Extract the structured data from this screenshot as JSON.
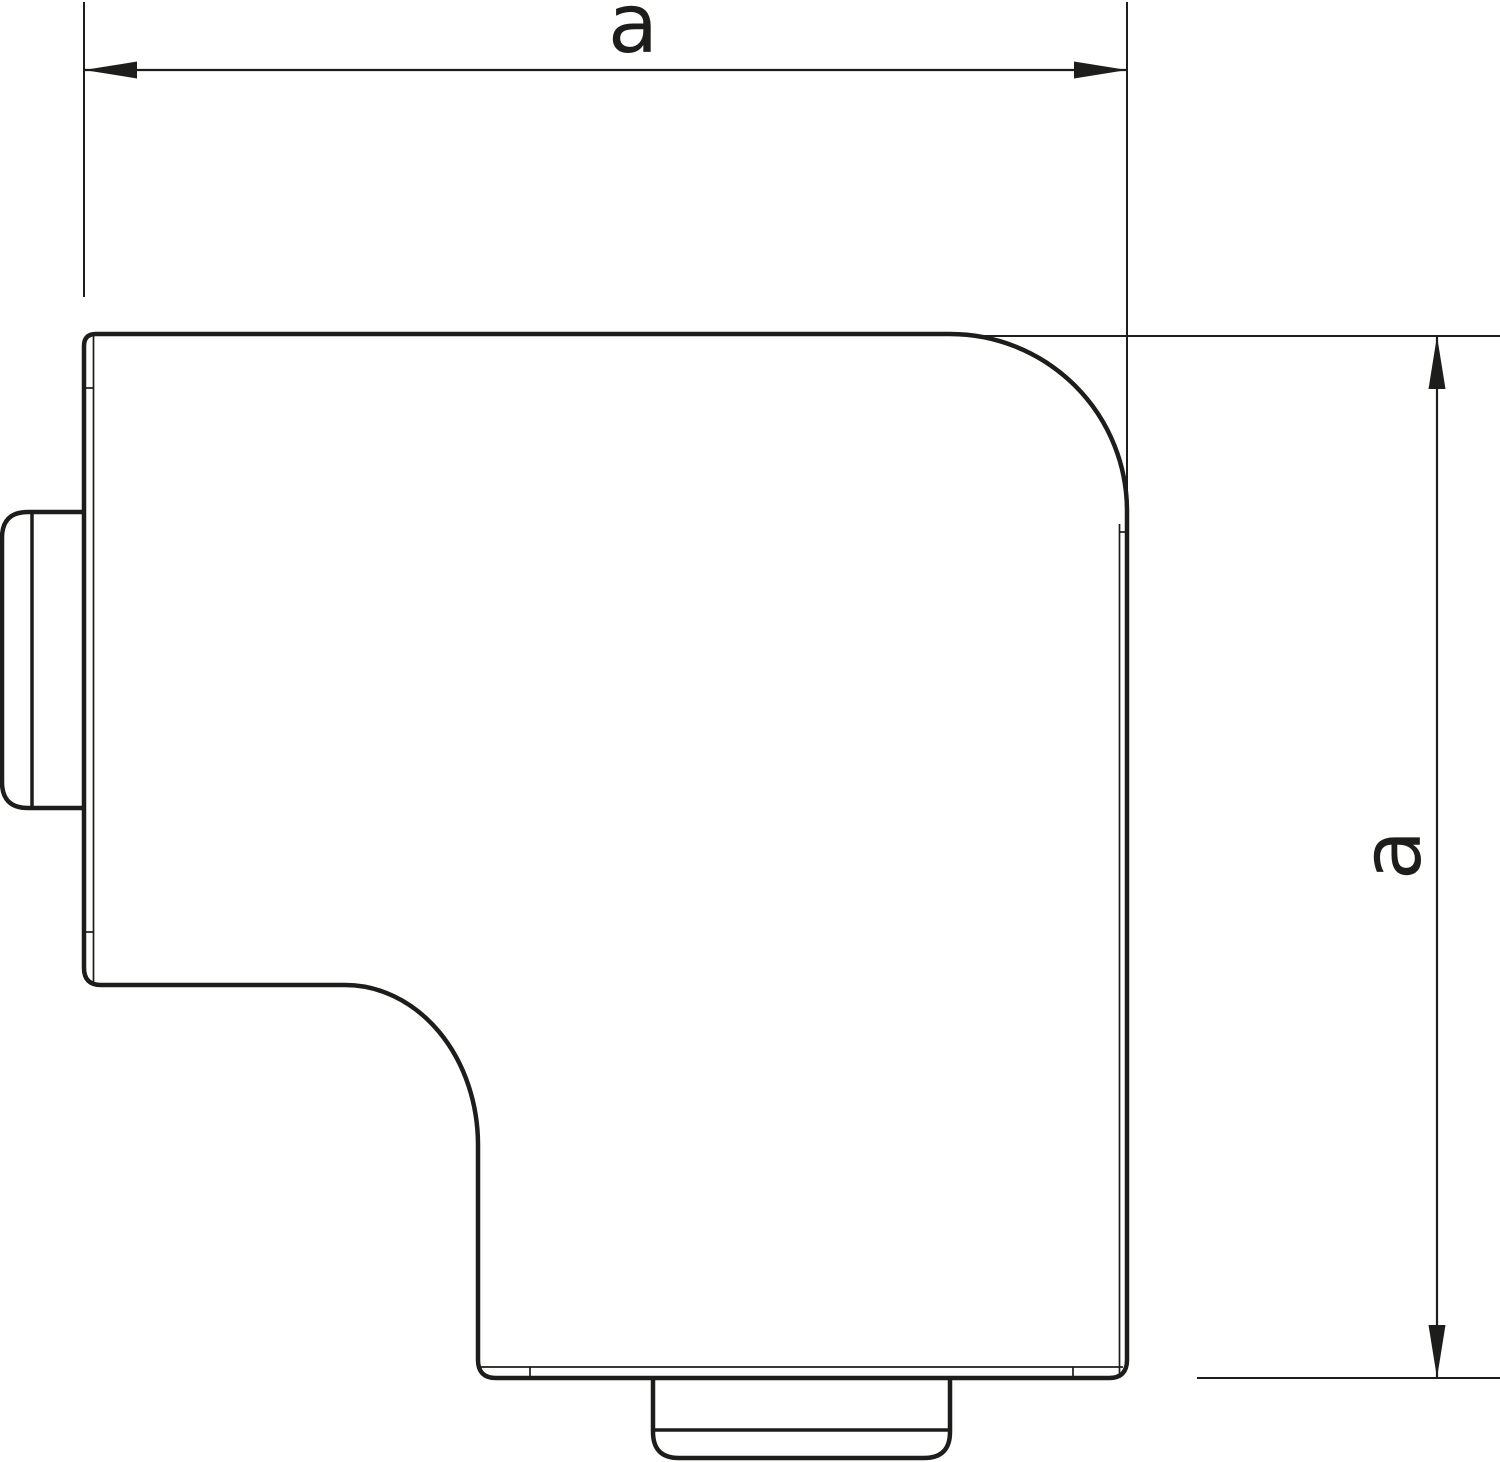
{
  "figure": {
    "description": "Technical outline drawing of a flat angle cover (90-degree trunking corner piece) with two connector stubs and equal overall dimensions"
  },
  "dimensions": {
    "width": {
      "label": "a"
    },
    "height": {
      "label": "a"
    }
  },
  "colors": {
    "line": "#1d1d1b",
    "background": "#ffffff"
  }
}
